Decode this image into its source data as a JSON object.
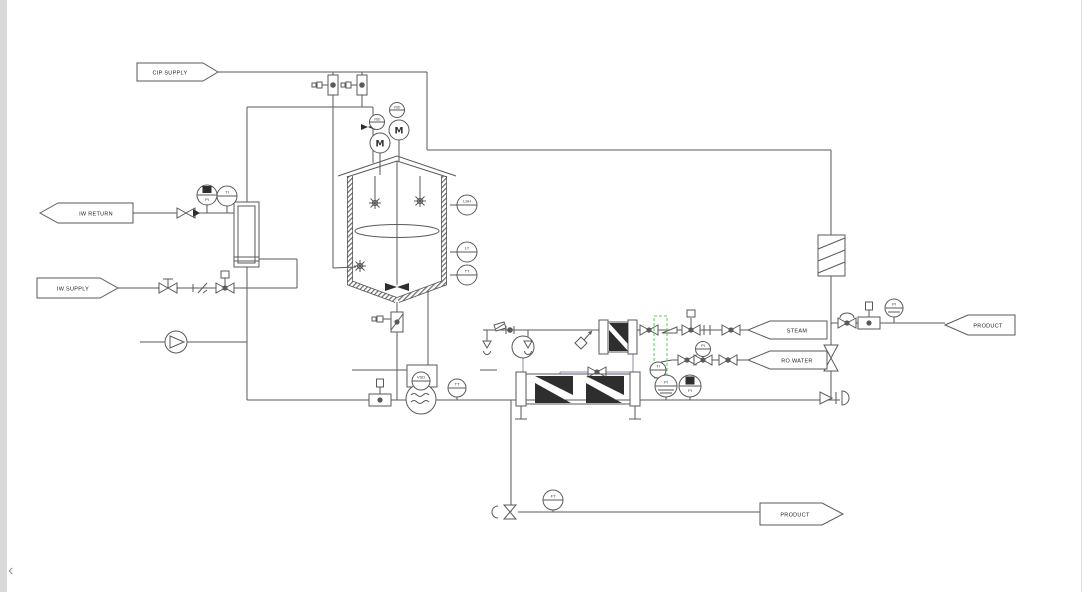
{
  "title": "Process P&ID - CIP / reactor / product transfer",
  "colors": {
    "bg": "#ffffff",
    "line": "#5a5a5a",
    "blue": "#8a8ab8",
    "green": "#5cc85c",
    "panel": "#d9d9d9"
  },
  "flags": {
    "cip_supply": "CIP SUPPLY",
    "iw_return": "IW RETURN",
    "iw_supply": "IW SUPPLY",
    "steam": "STEAM",
    "ro_water": "RO WATER",
    "product_right": "PRODUCT",
    "product_bottom": "PRODUCT"
  },
  "equipment": {
    "motor1": "M",
    "motor2": "M",
    "vsd1": "VSD",
    "vsd2": "VSD"
  },
  "instruments": [
    {
      "tag": "LSH"
    },
    {
      "tag": "LT"
    },
    {
      "tag": "TT"
    },
    {
      "tag": "PI"
    },
    {
      "tag": "TI"
    },
    {
      "tag": "VSD"
    },
    {
      "tag": "TT"
    },
    {
      "tag": "TI"
    },
    {
      "tag": "PI"
    },
    {
      "tag": "PI"
    },
    {
      "tag": "PI"
    },
    {
      "tag": "PI"
    },
    {
      "tag": "FT"
    }
  ],
  "nav": {
    "back": "‹"
  }
}
